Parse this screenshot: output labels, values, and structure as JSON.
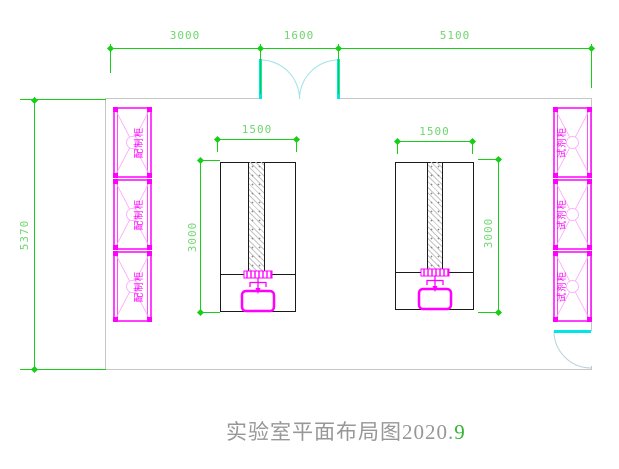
{
  "title": {
    "main": "实验室平面布局图2020.",
    "suffix": "9"
  },
  "dims": {
    "top_left": "3000",
    "top_door": "1600",
    "top_right": "5100",
    "room_depth": "5370",
    "bench_width": "1500",
    "bench_depth": "3000"
  },
  "cabinets": {
    "left_label": "配制柜",
    "right_label": "试剂柜"
  },
  "colors": {
    "dimension_green": "#17cf17",
    "fixture_magenta": "#ff00ff",
    "door_cyan": "#00e5e5",
    "wall_gray": "#c6c6c6",
    "bench_black": "#1a1a1a"
  }
}
